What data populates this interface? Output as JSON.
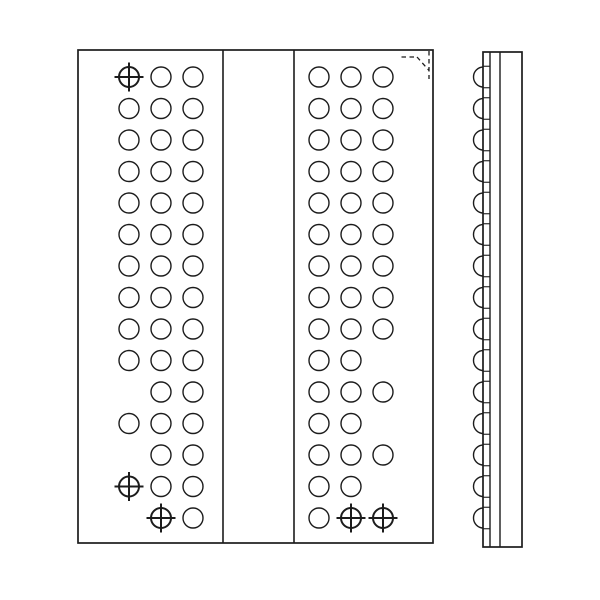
{
  "colors": {
    "background": "#ffffff",
    "line": "#1c1c1c"
  },
  "stroke": {
    "outline_width": 1.7,
    "channel_width": 1.6,
    "ball_width": 1.4,
    "target_width": 2,
    "target_cross_extent": 14.5,
    "corner_mark_width": 1.3,
    "side_line_width": 1.4
  },
  "front_view": {
    "outline": {
      "x": 78,
      "y": 50,
      "width": 355,
      "height": 493
    },
    "channel_lines_x": [
      223,
      294
    ],
    "ball_radius": 10,
    "rows": 15,
    "row_start_y": 77,
    "row_pitch": 31.5,
    "left_block_columns_x": [
      129,
      161,
      193
    ],
    "right_block_columns_x": [
      319,
      351,
      383
    ],
    "legend": {
      "O": "solder-ball",
      "T": "alignment-target-ball",
      ".": "no-ball"
    },
    "left_block_rows": [
      "TOO",
      "OOO",
      "OOO",
      "OOO",
      "OOO",
      "OOO",
      "OOO",
      "OOO",
      "OOO",
      "OOO",
      ".OO",
      "OOO",
      ".OO",
      "TOO",
      ".TO"
    ],
    "right_block_rows": [
      "OOO",
      "OOO",
      "OOO",
      "OOO",
      "OOO",
      "OOO",
      "OOO",
      "OOO",
      "OOO",
      "OO.",
      "OOO",
      "OO.",
      "OOO",
      "OO.",
      "OTT"
    ],
    "a1_corner_mark": {
      "dash": "4.5 3.5",
      "segments": [
        [
          401.5,
          57,
          417,
          57
        ],
        [
          417,
          57,
          429,
          70.5
        ],
        [
          429,
          51,
          429,
          79
        ]
      ]
    }
  },
  "side_view": {
    "outline": {
      "x": 483,
      "y": 52,
      "width": 39,
      "height": 495
    },
    "inner_lines_x": [
      490,
      500
    ],
    "ball_count": 15,
    "ball_start_y": 77,
    "ball_pitch": 31.5,
    "ball_radius": 10,
    "tick_offset": 10.75
  }
}
